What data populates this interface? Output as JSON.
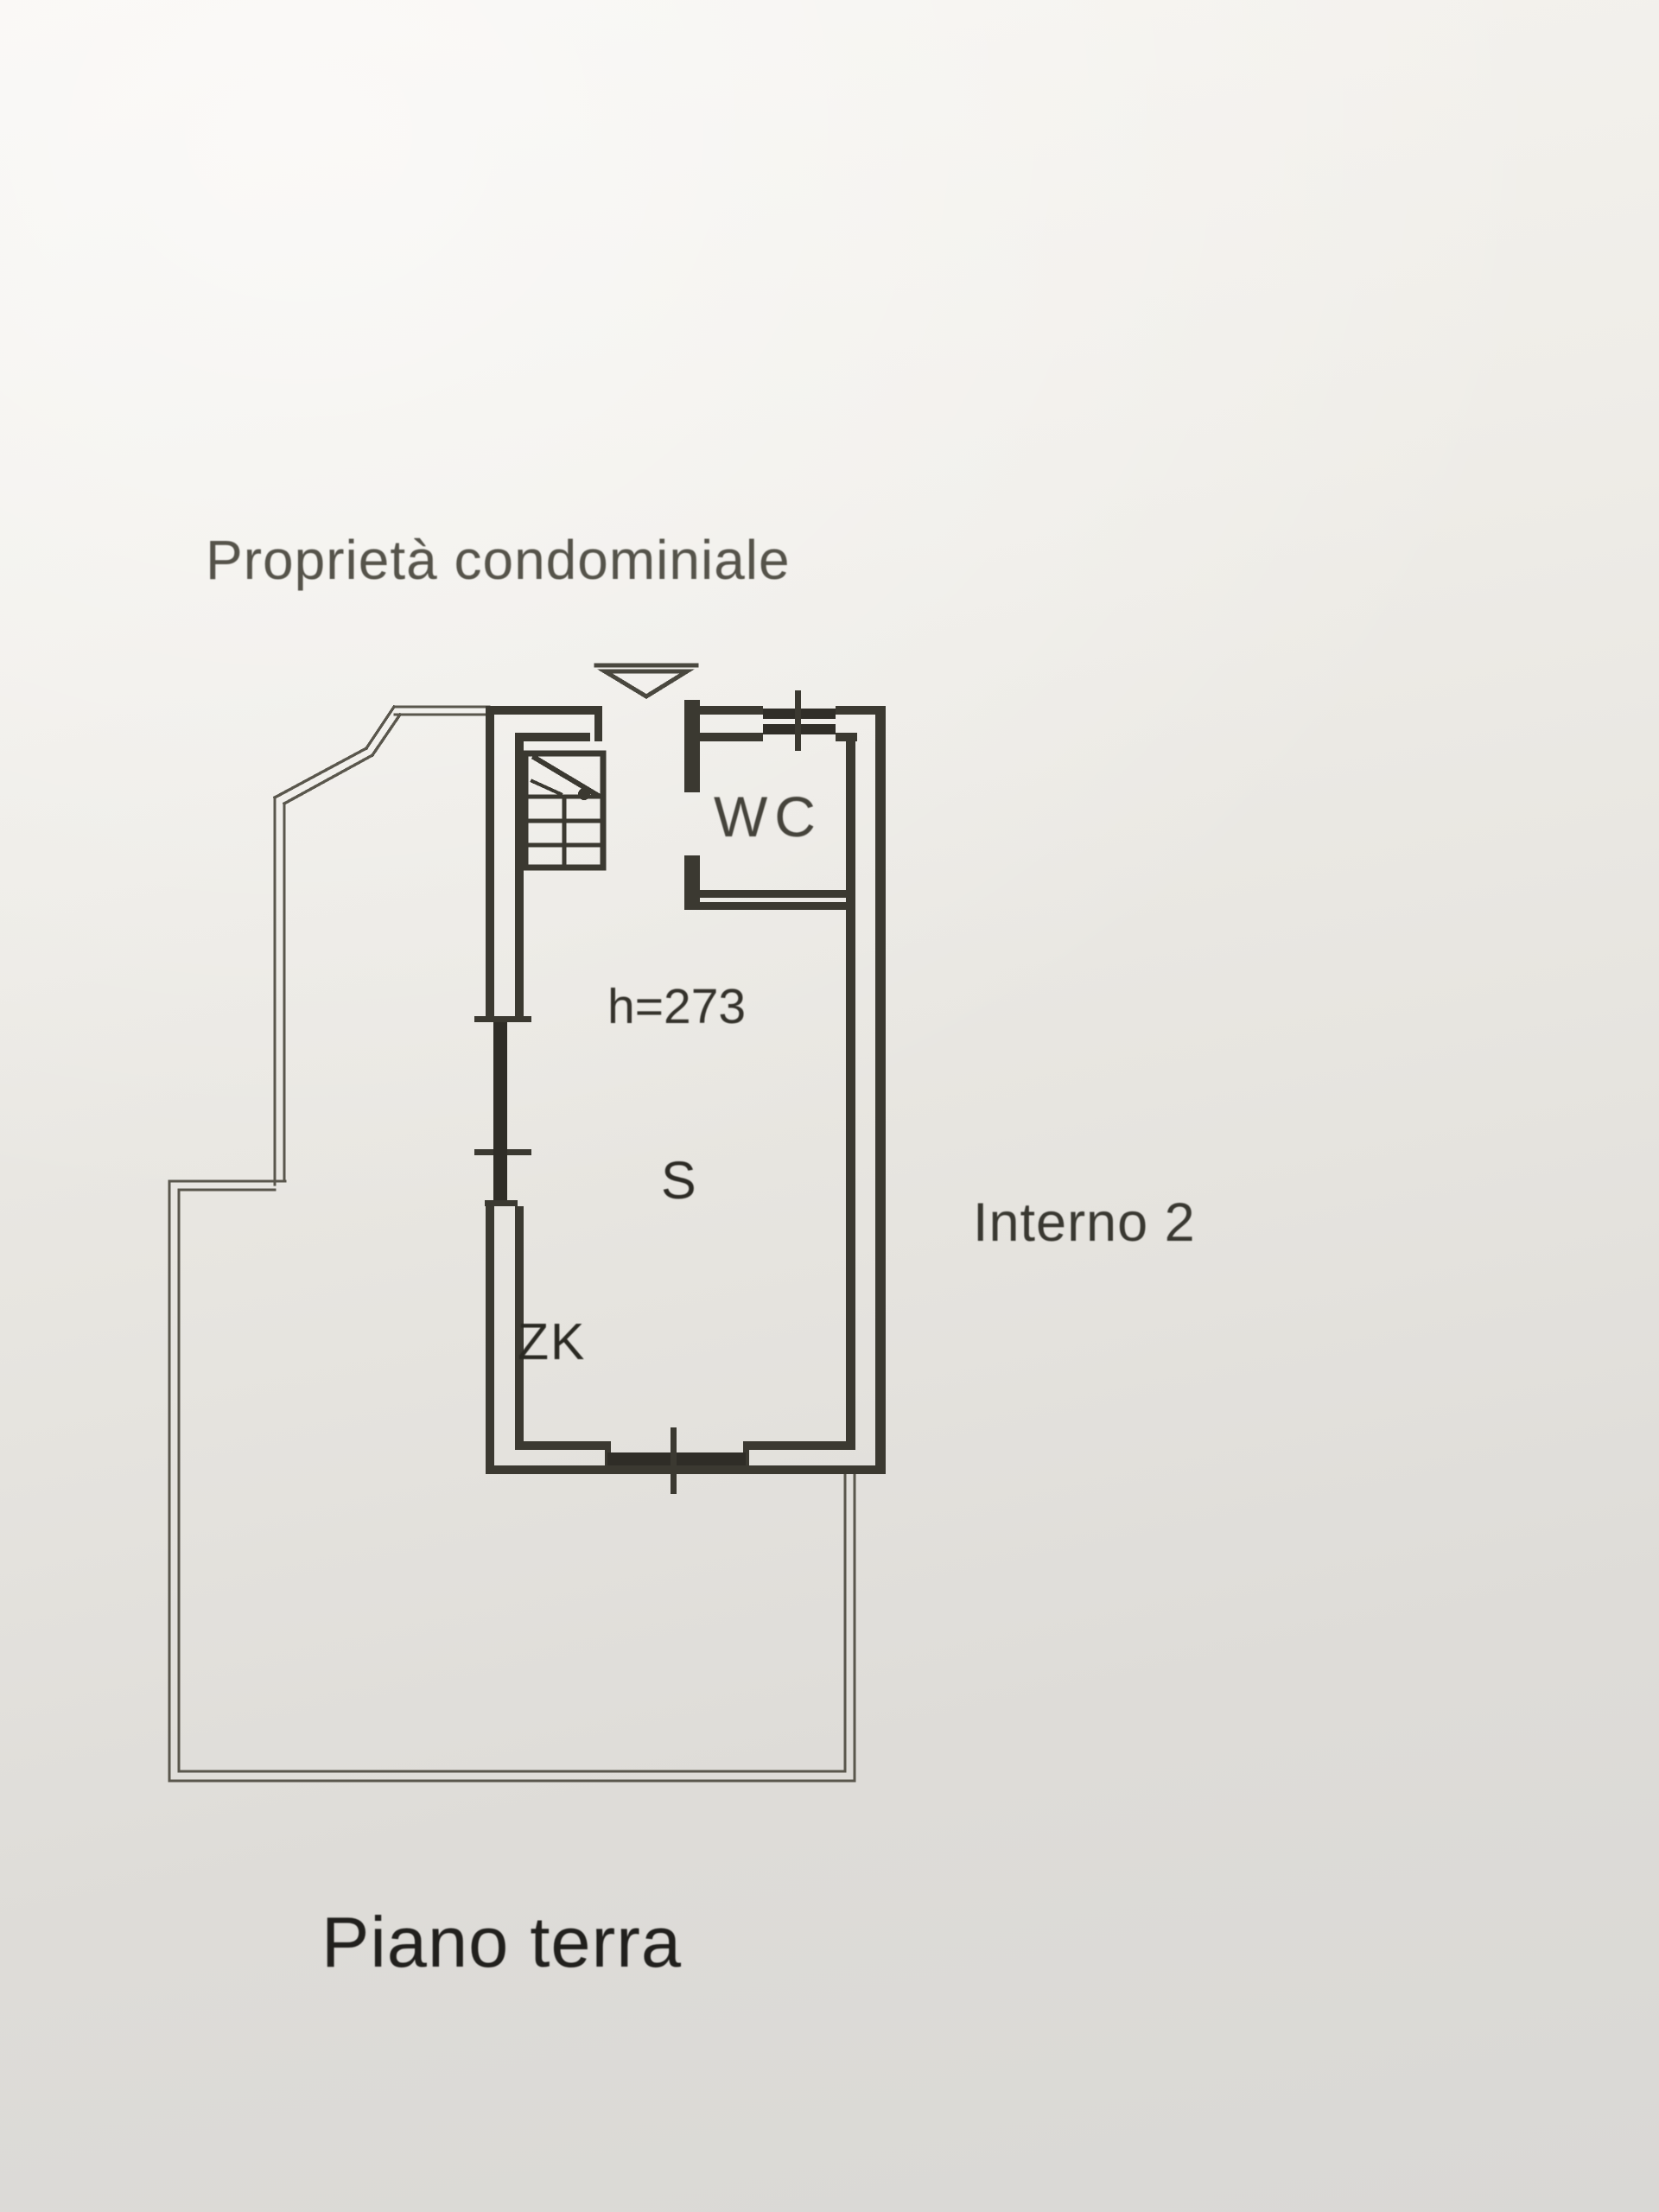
{
  "floor_plan": {
    "area_label": "Proprietà condominiale",
    "unit_label": "Interno 2",
    "floor_label": "Piano terra",
    "ceiling_height_label": "h=273",
    "rooms": {
      "wc_label": "WC",
      "main_room_label": "S",
      "zk_label": "ZK"
    },
    "colors": {
      "paper_top": "#f6f4f0",
      "paper_bottom": "#d9d8d5",
      "wall_ink": "#3b3931",
      "window_ink": "#2f2d27",
      "boundary_ink": "#5a574d",
      "text_ink": "#34322b"
    }
  }
}
